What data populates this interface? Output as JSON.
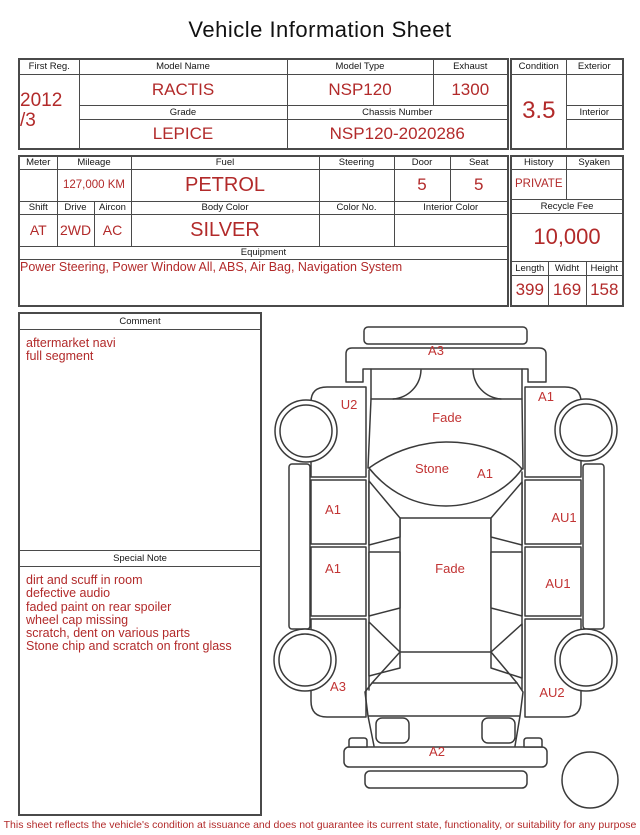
{
  "title": "Vehicle Information Sheet",
  "table1": {
    "first_reg": {
      "label": "First Reg.",
      "value_line1": "2012",
      "value_line2": "/3"
    },
    "model_name": {
      "label": "Model Name",
      "value": "RACTIS"
    },
    "model_type": {
      "label": "Model Type",
      "value": "NSP120"
    },
    "exhaust": {
      "label": "Exhaust",
      "value": "1300"
    },
    "grade": {
      "label": "Grade",
      "value": "LEPICE"
    },
    "chassis_number": {
      "label": "Chassis Number",
      "value": "NSP120-2020286"
    }
  },
  "condition_box": {
    "condition": {
      "label": "Condition",
      "value": "3.5"
    },
    "exterior": {
      "label": "Exterior",
      "value": ""
    },
    "interior": {
      "label": "Interior",
      "value": ""
    }
  },
  "table2": {
    "meter": {
      "label": "Meter",
      "value": ""
    },
    "mileage": {
      "label": "Mileage",
      "value": "127,000 KM"
    },
    "fuel": {
      "label": "Fuel",
      "value": "PETROL"
    },
    "steering": {
      "label": "Steering",
      "value": ""
    },
    "door": {
      "label": "Door",
      "value": "5"
    },
    "seat": {
      "label": "Seat",
      "value": "5"
    },
    "shift": {
      "label": "Shift",
      "value": "AT"
    },
    "drive": {
      "label": "Drive",
      "value": "2WD"
    },
    "aircon": {
      "label": "Aircon",
      "value": "AC"
    },
    "body_color": {
      "label": "Body Color",
      "value": "SILVER"
    },
    "color_no": {
      "label": "Color No.",
      "value": ""
    },
    "interior_color": {
      "label": "Interior Color",
      "value": ""
    },
    "equipment": {
      "label": "Equipment",
      "value": "Power Steering, Power Window  All, ABS, Air Bag, Navigation System"
    }
  },
  "history_box": {
    "history": {
      "label": "History",
      "value": "PRIVATE"
    },
    "syaken": {
      "label": "Syaken",
      "value": ""
    },
    "recycle_fee": {
      "label": "Recycle Fee",
      "value": "10,000"
    },
    "length": {
      "label": "Length",
      "value": "399"
    },
    "width": {
      "label": "Widht",
      "value": "169"
    },
    "height": {
      "label": "Height",
      "value": "158"
    }
  },
  "comment": {
    "label": "Comment",
    "lines": [
      "aftermarket navi",
      "full segment"
    ]
  },
  "special_note": {
    "label": "Special Note",
    "lines": [
      "dirt and scuff in room",
      "defective audio",
      "faded paint on rear spoiler",
      "wheel cap missing",
      "scratch, dent on various parts",
      "Stone chip and scratch on front glass"
    ]
  },
  "diagram": {
    "labels": [
      {
        "part": "front-bumper",
        "text": "A3"
      },
      {
        "part": "left-front-fender",
        "text": "U2"
      },
      {
        "part": "right-front-fender",
        "text": "A1"
      },
      {
        "part": "hood",
        "text": "Fade"
      },
      {
        "part": "windshield-stone",
        "text": "Stone"
      },
      {
        "part": "windshield-right",
        "text": "A1"
      },
      {
        "part": "left-front-door",
        "text": "A1"
      },
      {
        "part": "right-front-door",
        "text": "AU1"
      },
      {
        "part": "left-rear-door",
        "text": "A1"
      },
      {
        "part": "roof",
        "text": "Fade"
      },
      {
        "part": "right-rear-door",
        "text": "AU1"
      },
      {
        "part": "left-rear-quarter",
        "text": "A3"
      },
      {
        "part": "right-rear-quarter",
        "text": "AU2"
      },
      {
        "part": "rear-bumper",
        "text": "A2"
      }
    ]
  },
  "footer": {
    "disclaimer": "This sheet reflects the vehicle's condition at issuance and does not guarantee its current state, functionality, or suitability for any purpose"
  },
  "colors": {
    "accent_red": "#b22a2a",
    "border": "#4a4a4a"
  }
}
